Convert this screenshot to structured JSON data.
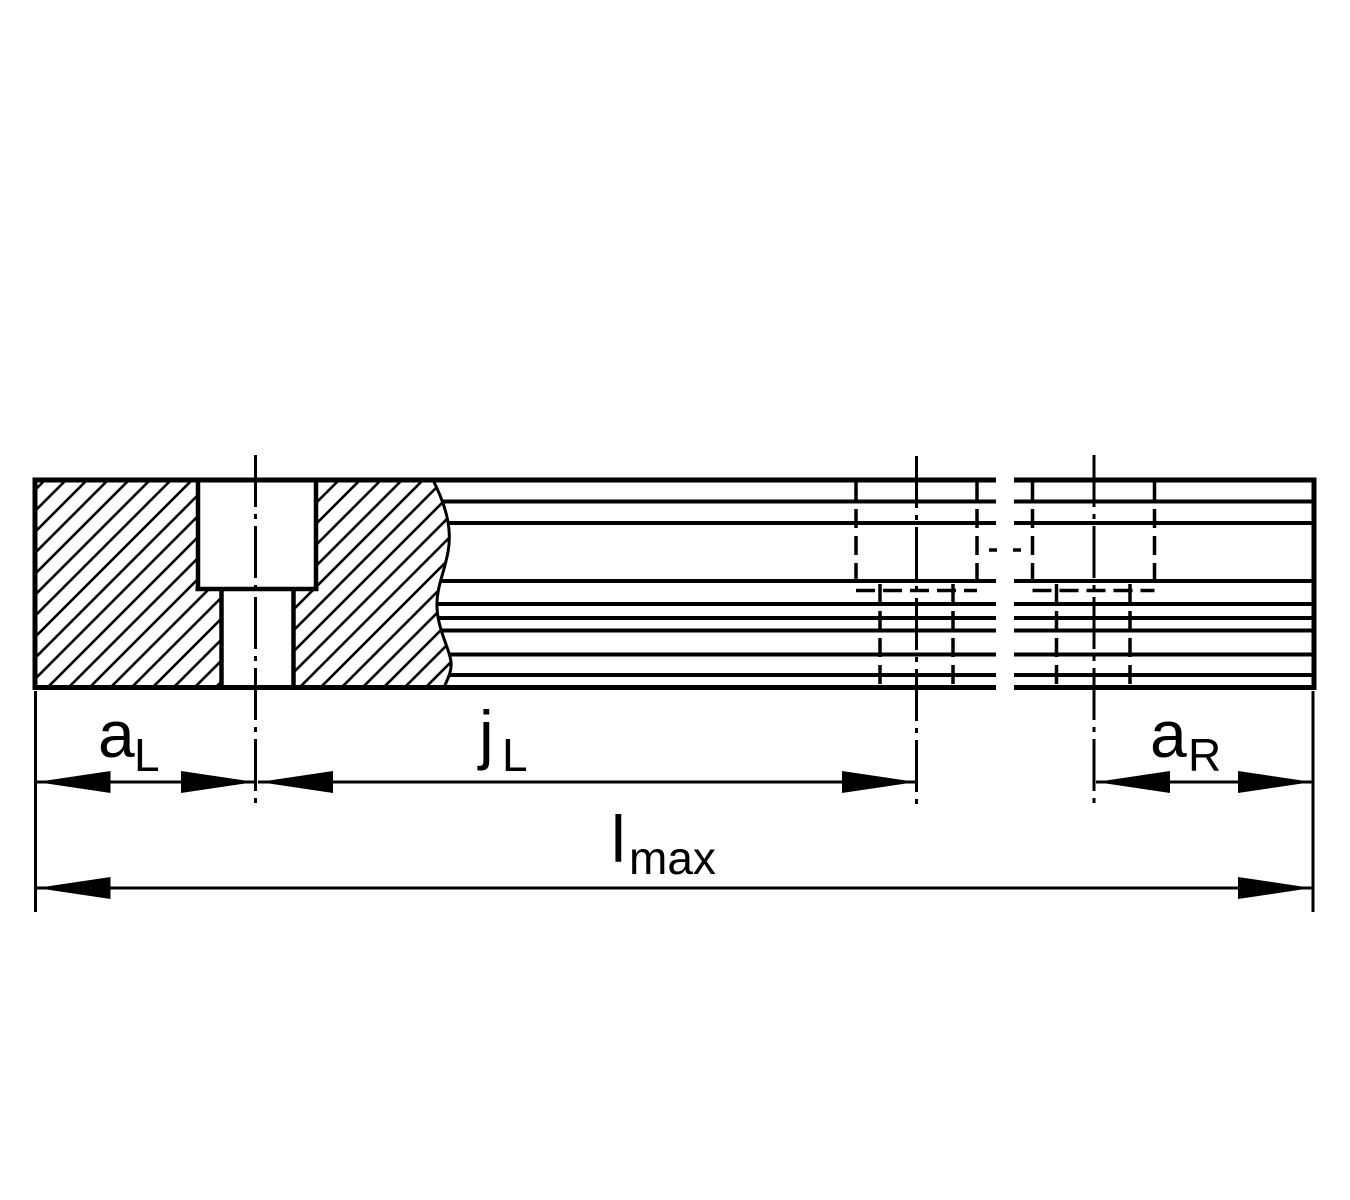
{
  "drawing": {
    "description": "rail-section-technical-drawing",
    "colors": {
      "line": "#000000",
      "background": "#ffffff"
    },
    "labels": {
      "a_left": {
        "main": "a",
        "sub": "L"
      },
      "j_left": {
        "main": "j",
        "sub": "L"
      },
      "a_right": {
        "main": "a",
        "sub": "R"
      },
      "l_max": {
        "main": "l",
        "sub": "max"
      }
    }
  }
}
